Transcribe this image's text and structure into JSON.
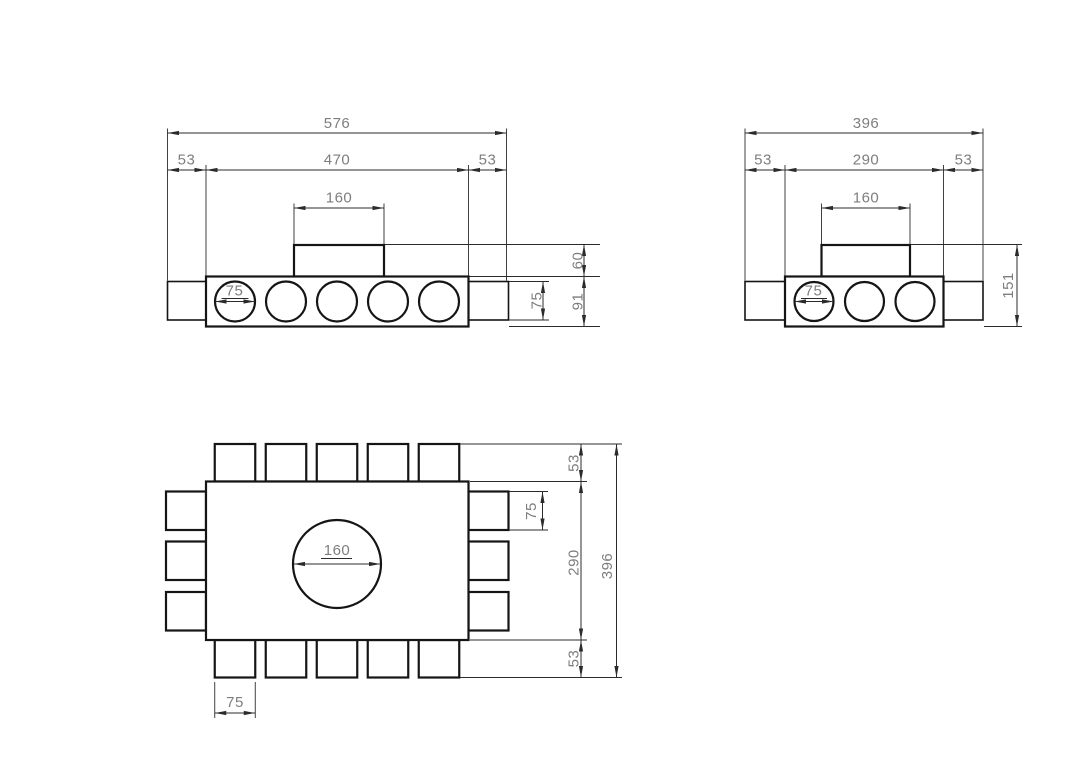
{
  "colors": {
    "background": "#ffffff",
    "outline": "#151515",
    "dimension_lines": "#2b2b2b",
    "dimension_text": "#7e7e7e"
  },
  "views": {
    "front_wide": {
      "total_width": "576",
      "inner_width": "470",
      "left_margin": "53",
      "right_margin": "53",
      "collar_width": "160",
      "port_diameter": "75",
      "collar_height": "60",
      "body_height": "91",
      "stub_height": "75"
    },
    "front_narrow": {
      "total_width": "396",
      "inner_width": "290",
      "left_margin": "53",
      "right_margin": "53",
      "collar_width": "160",
      "port_diameter": "75",
      "total_height": "151"
    },
    "plan": {
      "top_stub_depth": "53",
      "right_stub_width": "75",
      "inner_depth": "290",
      "total_depth": "396",
      "bottom_stub_depth": "53",
      "centre_hole_diameter": "160",
      "bottom_stub_width": "75"
    }
  }
}
